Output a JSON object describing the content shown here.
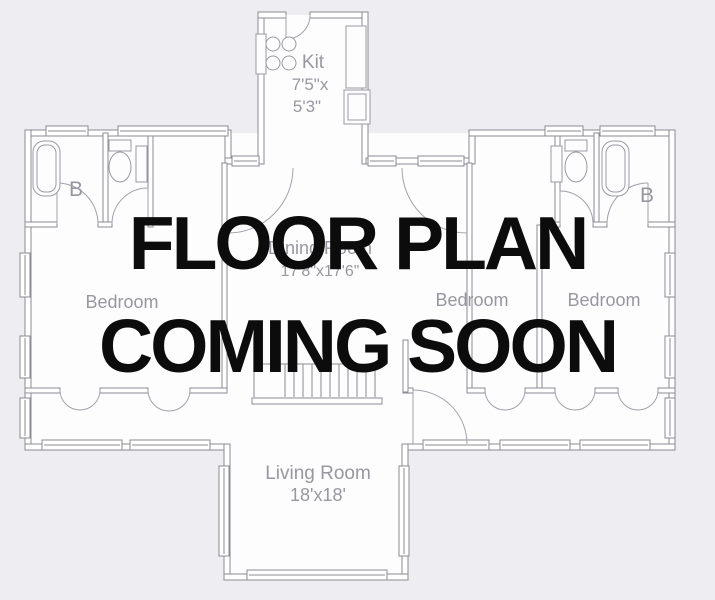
{
  "overlay": {
    "line1": "FLOOR PLAN",
    "line2": "COMING SOON",
    "text_color": "#0c0c0c"
  },
  "palette": {
    "background": "#eeedf2",
    "room_fill": "#fdfdfe",
    "wall_line": "#8b8b93",
    "fixture_line": "#9a9aa2",
    "label_text": "#97979e"
  },
  "rooms": {
    "kitchen": {
      "label": "Kit",
      "dim1": "7'5\"x",
      "dim2": "5'3\""
    },
    "bath_left": {
      "label": "B"
    },
    "bath_right": {
      "label": "B"
    },
    "bedroom_left": {
      "label": "Bedroom"
    },
    "dining": {
      "label": "Dining Room",
      "dims": "17'8\"x17'6\""
    },
    "bedroom_mid": {
      "label": "Bedroom"
    },
    "bedroom_right": {
      "label": "Bedroom"
    },
    "living": {
      "label": "Living Room",
      "dims": "18'x18'"
    }
  }
}
